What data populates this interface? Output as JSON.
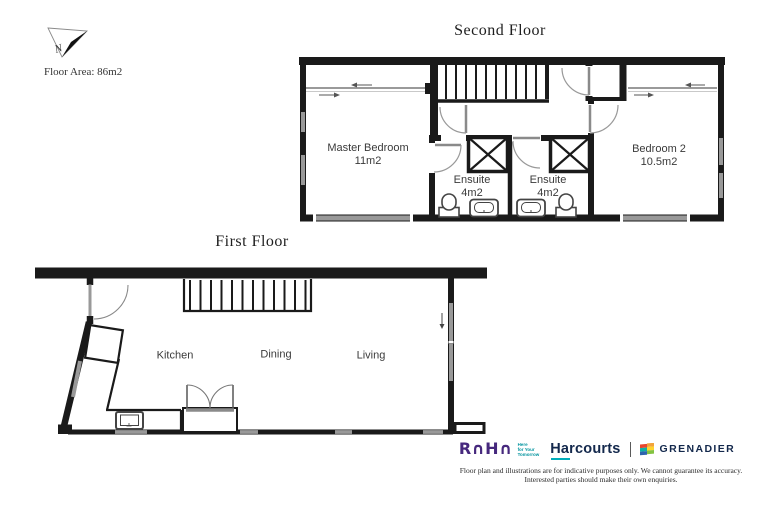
{
  "header": {
    "floor_area_label": "Floor Area: 86m2",
    "north_label": "N"
  },
  "second_floor": {
    "title": "Second Floor",
    "rooms": {
      "master_bedroom": {
        "name": "Master Bedroom",
        "area": "11m2"
      },
      "ensuite_left": {
        "name": "Ensuite",
        "area": "4m2"
      },
      "ensuite_right": {
        "name": "Ensuite",
        "area": "4m2"
      },
      "bedroom_2": {
        "name": "Bedroom 2",
        "area": "10.5m2"
      }
    }
  },
  "first_floor": {
    "title": "First Floor",
    "rooms": {
      "kitchen": {
        "name": "Kitchen"
      },
      "dining": {
        "name": "Dining"
      },
      "living": {
        "name": "Living"
      }
    }
  },
  "footer": {
    "raha": {
      "logo_text": "R∩H∩",
      "tagline_line1": "Here",
      "tagline_line2": "for Your",
      "tagline_line3": "Tomorrow"
    },
    "harcourts_label": "Harcourts",
    "grenadier_label": "GRENADIER",
    "disclaimer_line1": "Floor plan and illustrations are for indicative purposes only. We cannot guarantee its accuracy.",
    "disclaimer_line2": "Interested parties should make their own enquiries."
  },
  "colors": {
    "wall": "#1a1a1a",
    "window_gray": "#999999",
    "raha_purple": "#46287d",
    "harcourts_navy": "#13284c",
    "accent_teal": "#00adbb"
  }
}
